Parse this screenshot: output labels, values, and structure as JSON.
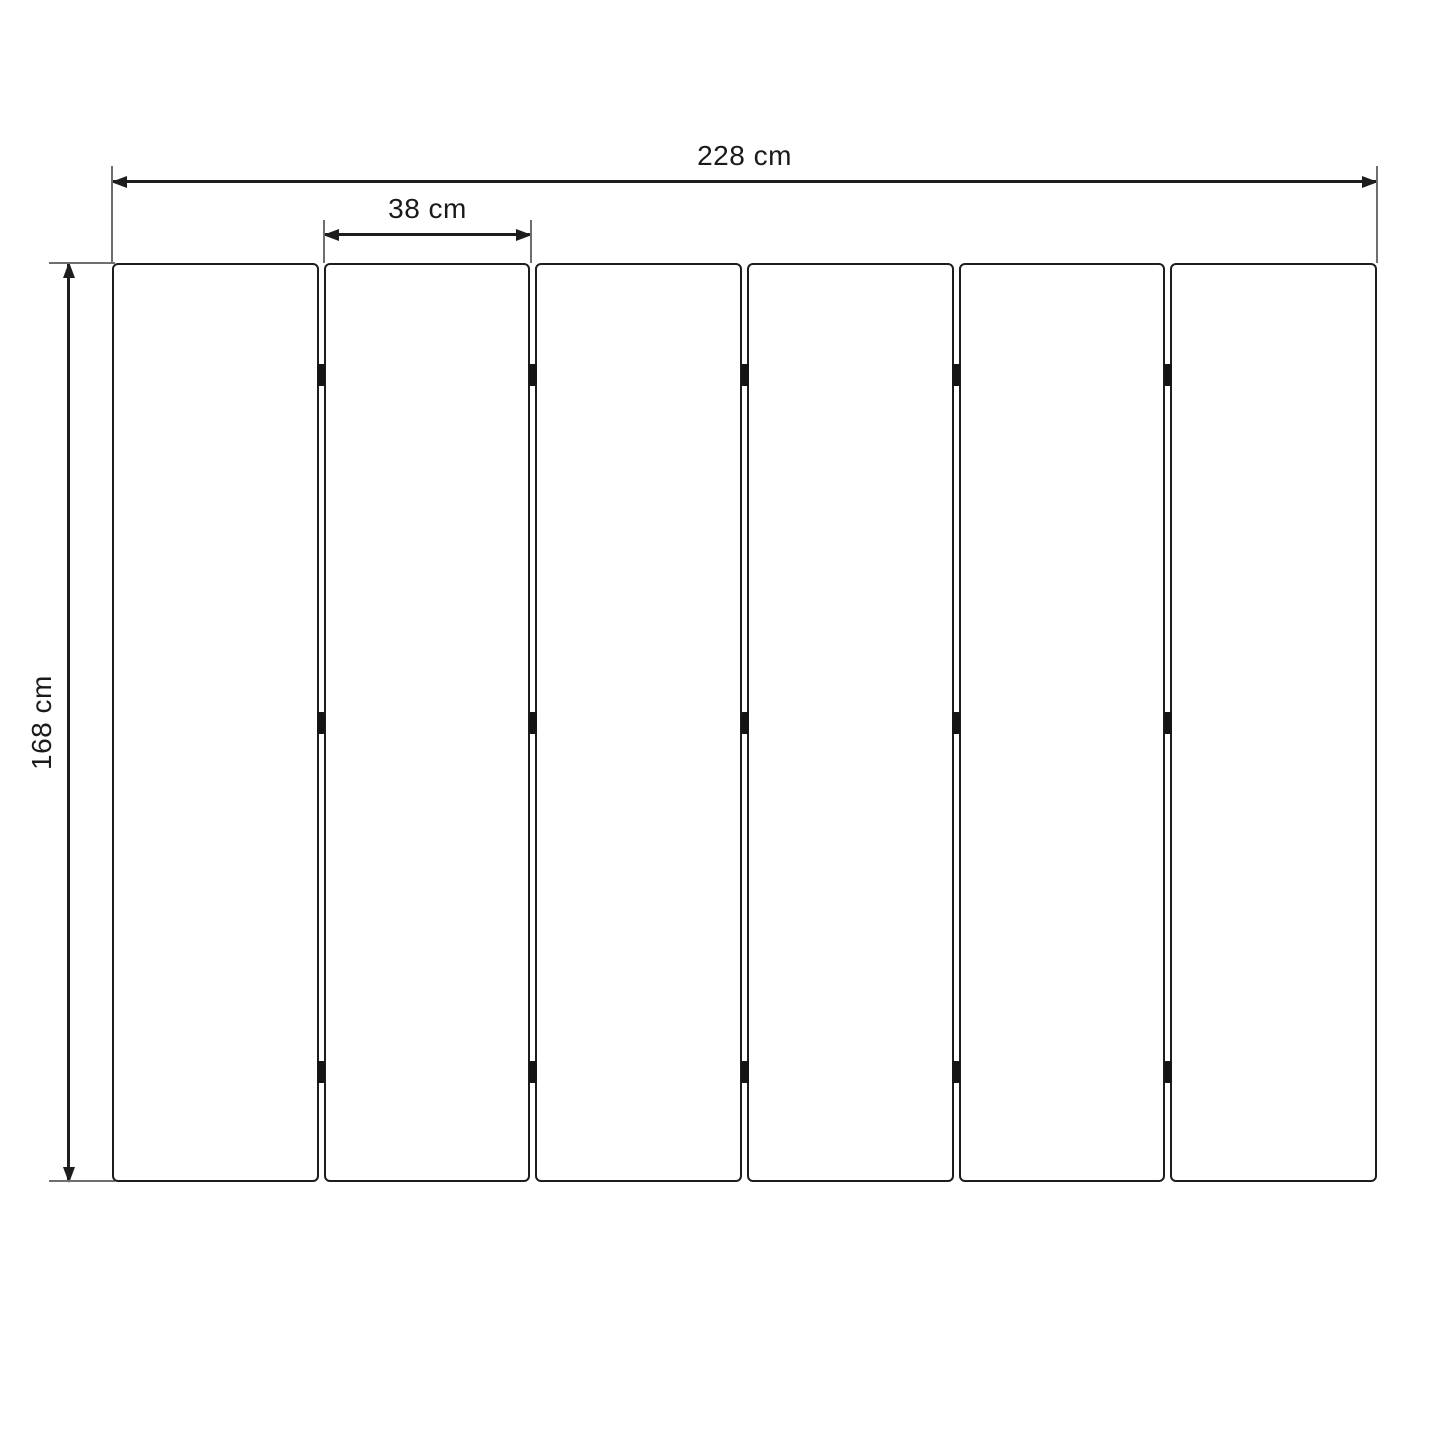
{
  "diagram": {
    "title": "folding-screen-panel-dimension-diagram",
    "background_color": "#ffffff",
    "line_color": "#1d1d1d",
    "extension_line_color": "#6e6e6e",
    "text_color": "#1a1a1a"
  },
  "dimensions": {
    "total_width": "228 cm",
    "panel_width": "38 cm",
    "height": "168 cm"
  },
  "panels": {
    "count": 6,
    "gap_px": 5,
    "hinges_per_gap": 3,
    "hinge_rows_pct": [
      12.2,
      50,
      88
    ],
    "hinge_color": "#141414"
  }
}
